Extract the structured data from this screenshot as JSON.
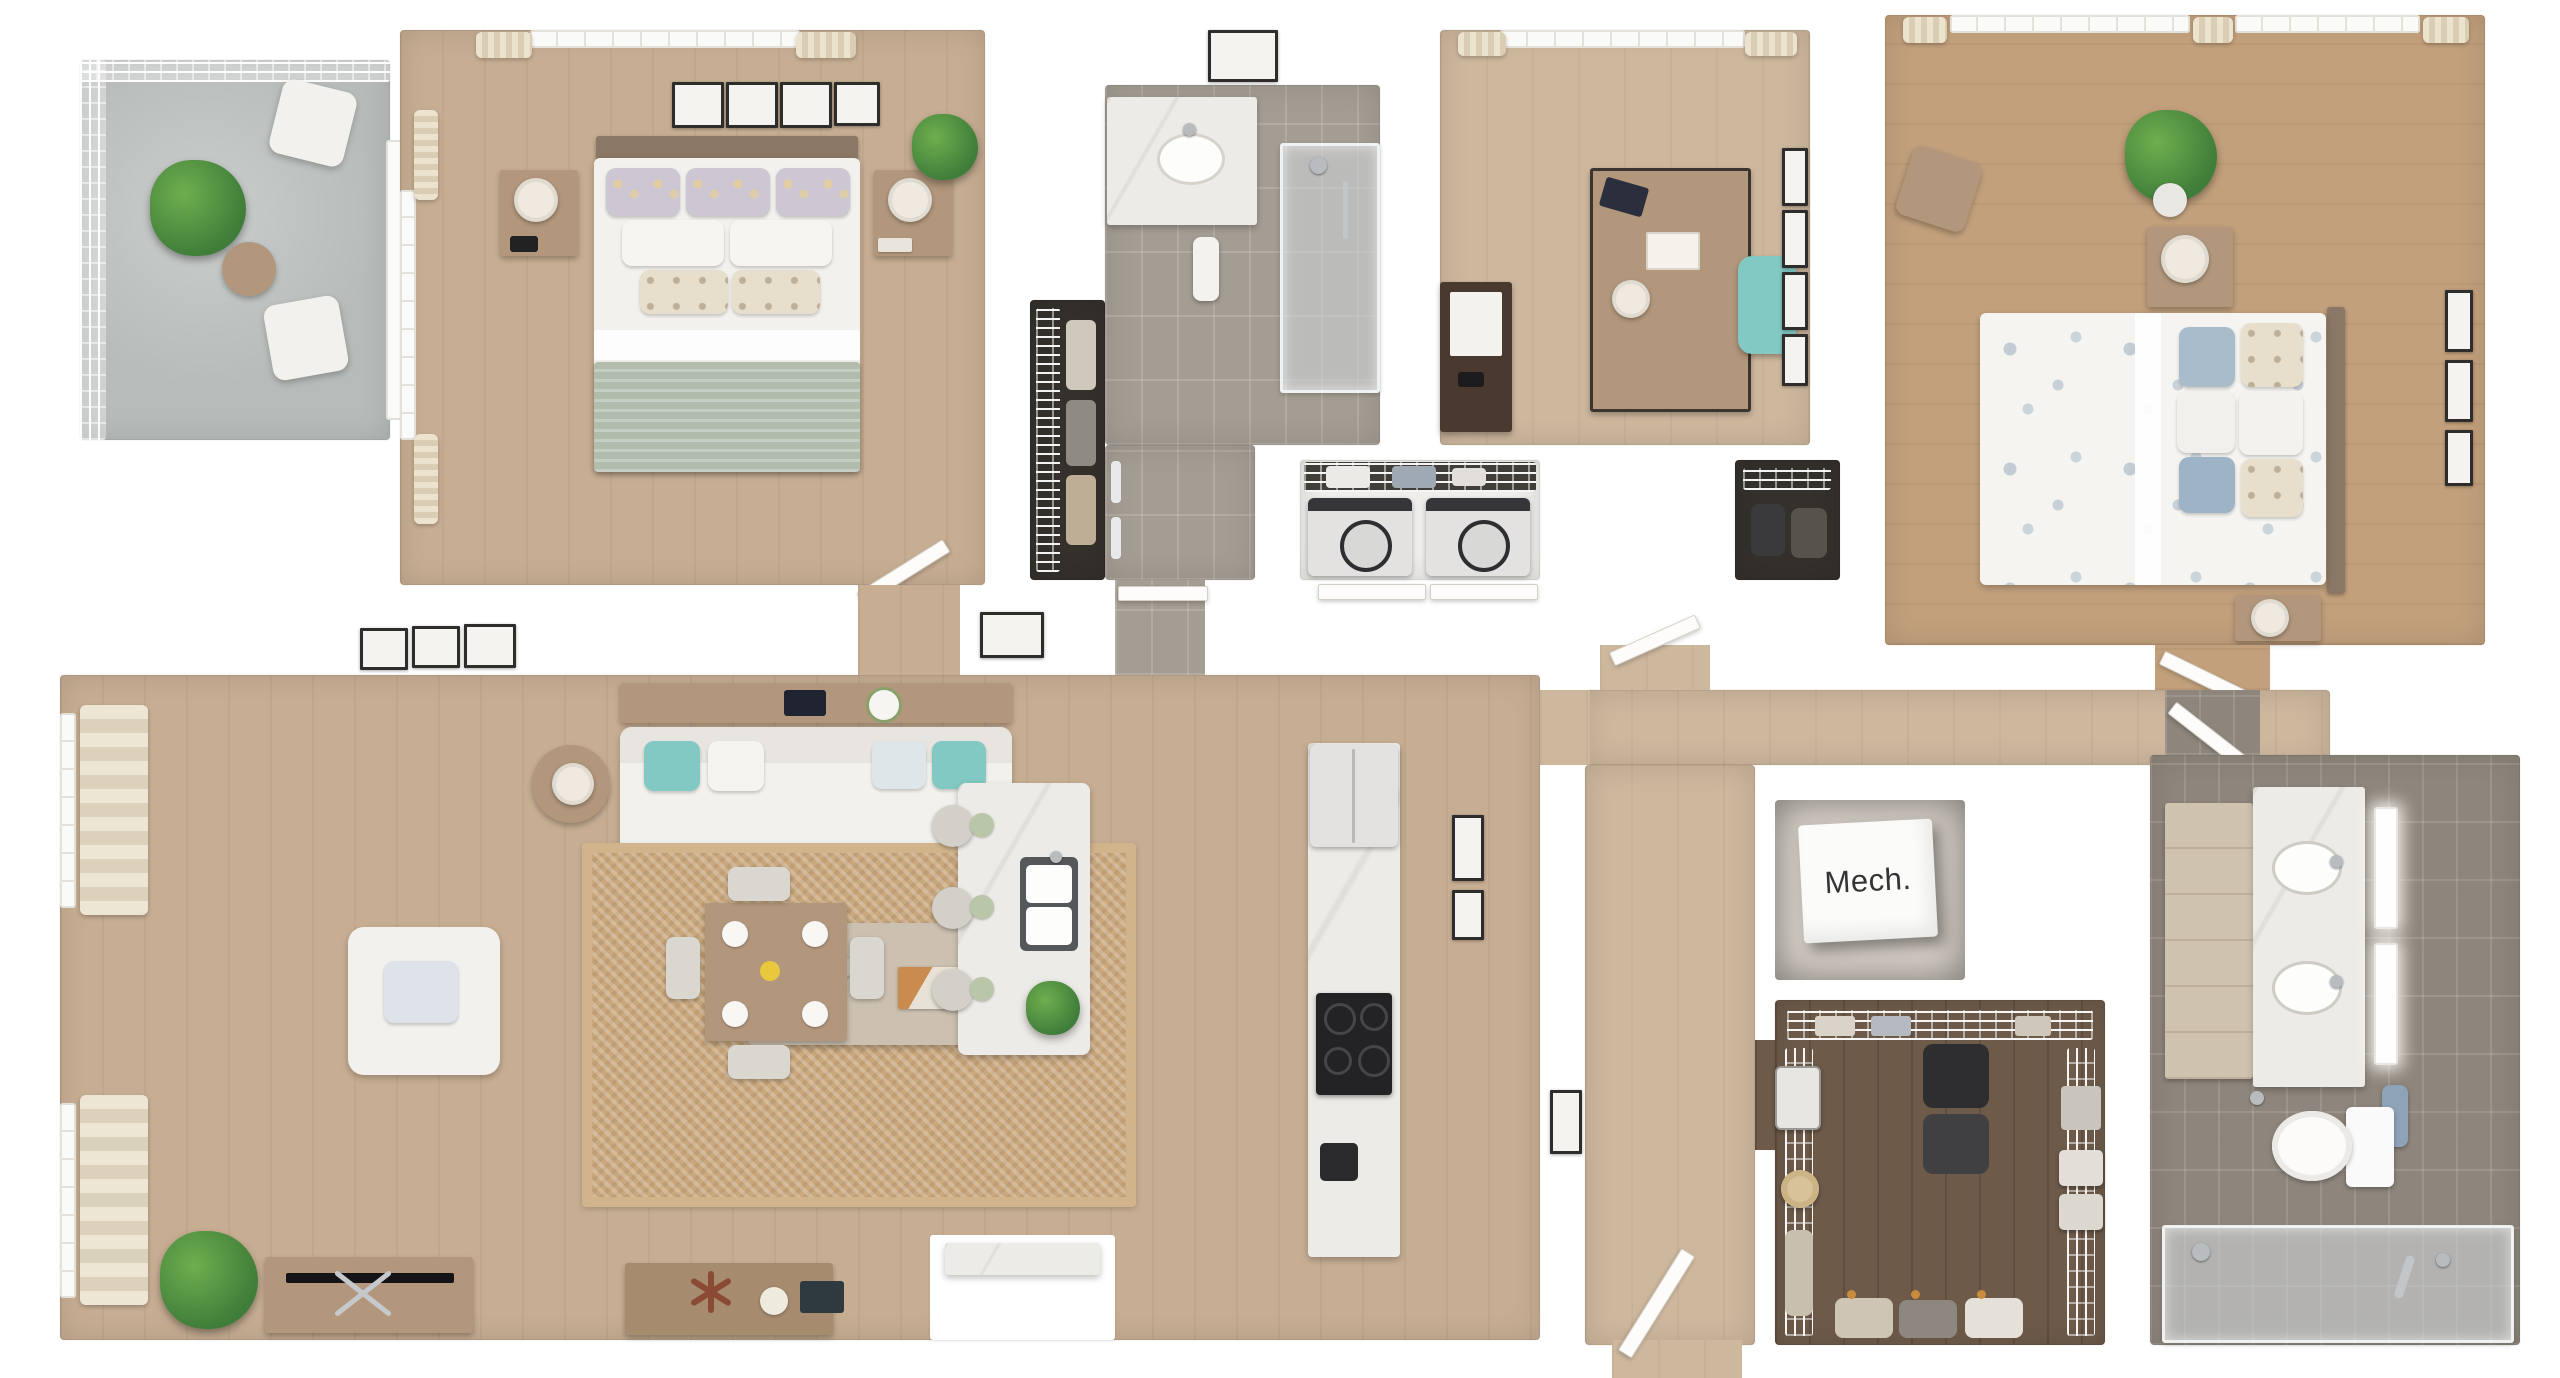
{
  "labels": {
    "mech": "Mech."
  },
  "colors": {
    "wood_main": "#c7ae93",
    "wood_pale": "#cdb79d",
    "wood_warm": "#c2a07c",
    "wood_dark": "#6d5a49",
    "tile_light": "#a49d93",
    "tile_dark": "#8e867c",
    "concrete": "#b7bcba",
    "marble": "#edebe7",
    "furniture_wood": "#b2977c",
    "white_fabric": "#f3f1ed",
    "sage": "#b2bcad",
    "teal": "#82c8c3",
    "jute": "#c9a87e",
    "dark_closet": "#34302c",
    "appliance": "#e3e2e0",
    "plant": "#3f7d3a",
    "plant_light": "#6fae4e",
    "towel_blue": "#8fa3b8",
    "frame_dark": "#2f2d2b",
    "chrome": "#b9bcbf",
    "lamp_shade": "#efe9df",
    "headboard": "#8a7765"
  }
}
